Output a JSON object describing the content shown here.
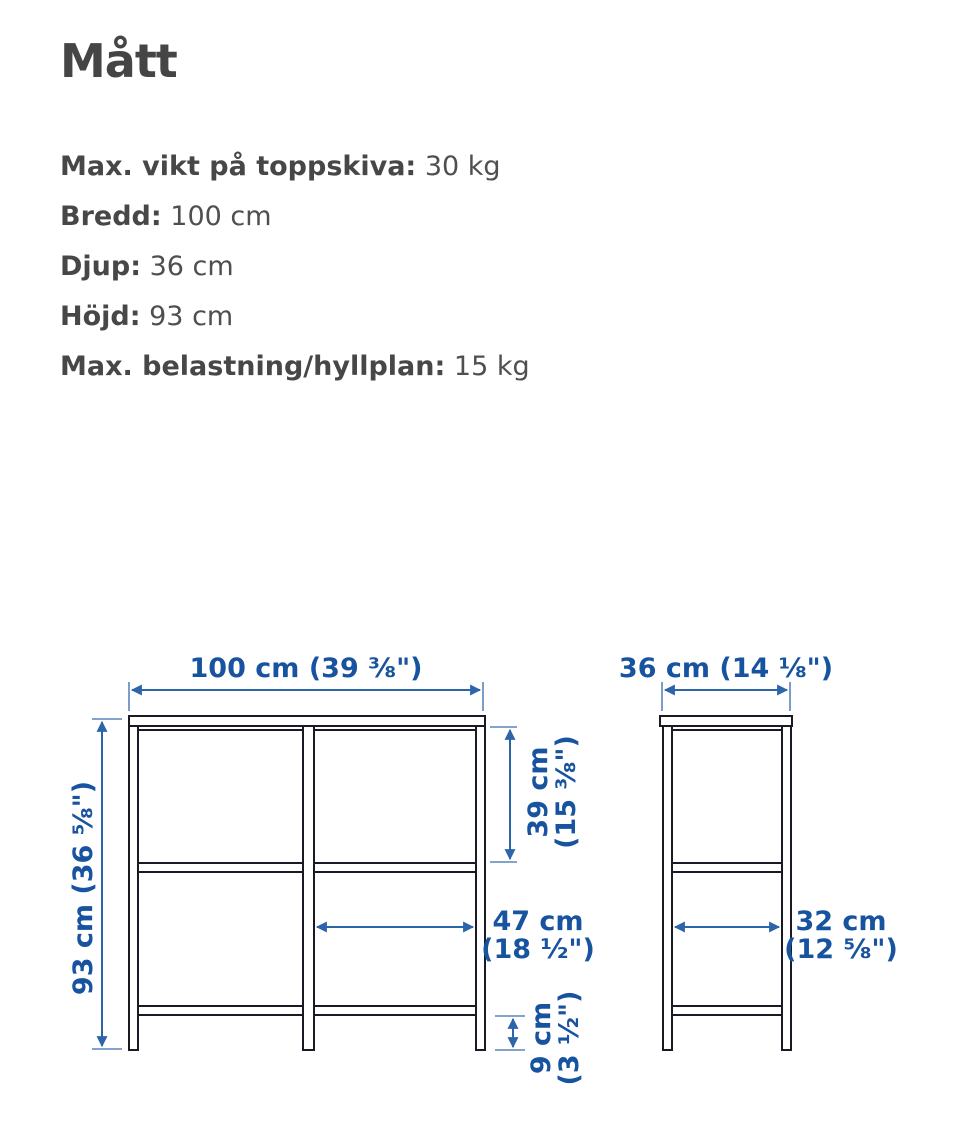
{
  "title": "Mått",
  "specs": [
    {
      "label": "Max. vikt på toppskiva:",
      "value": "30 kg"
    },
    {
      "label": "Bredd:",
      "value": "100 cm"
    },
    {
      "label": "Djup:",
      "value": "36 cm"
    },
    {
      "label": "Höjd:",
      "value": "93 cm"
    },
    {
      "label": "Max. belastning/hyllplan:",
      "value": "15 kg"
    }
  ],
  "colors": {
    "dimension_blue": "#17539E",
    "dimension_line_blue": "#2E64A9",
    "drawing_line": "#191A23",
    "text_gray": "#4A4A4A"
  },
  "diagram": {
    "front": {
      "width": "100 cm (39 ⅜\")",
      "height": "93 cm (36 ⅝\")",
      "shelf_spacing": {
        "line1": "39 cm",
        "line2": "(15 ⅜\")"
      },
      "inner_width": {
        "line1": "47 cm",
        "line2": "(18 ½\")"
      },
      "bottom_clearance": {
        "line1": "9 cm",
        "line2": "(3 ½\")"
      }
    },
    "side": {
      "depth": "36 cm (14 ⅛\")",
      "inner_depth": {
        "line1": "32 cm",
        "line2": "(12 ⅝\")"
      }
    }
  }
}
